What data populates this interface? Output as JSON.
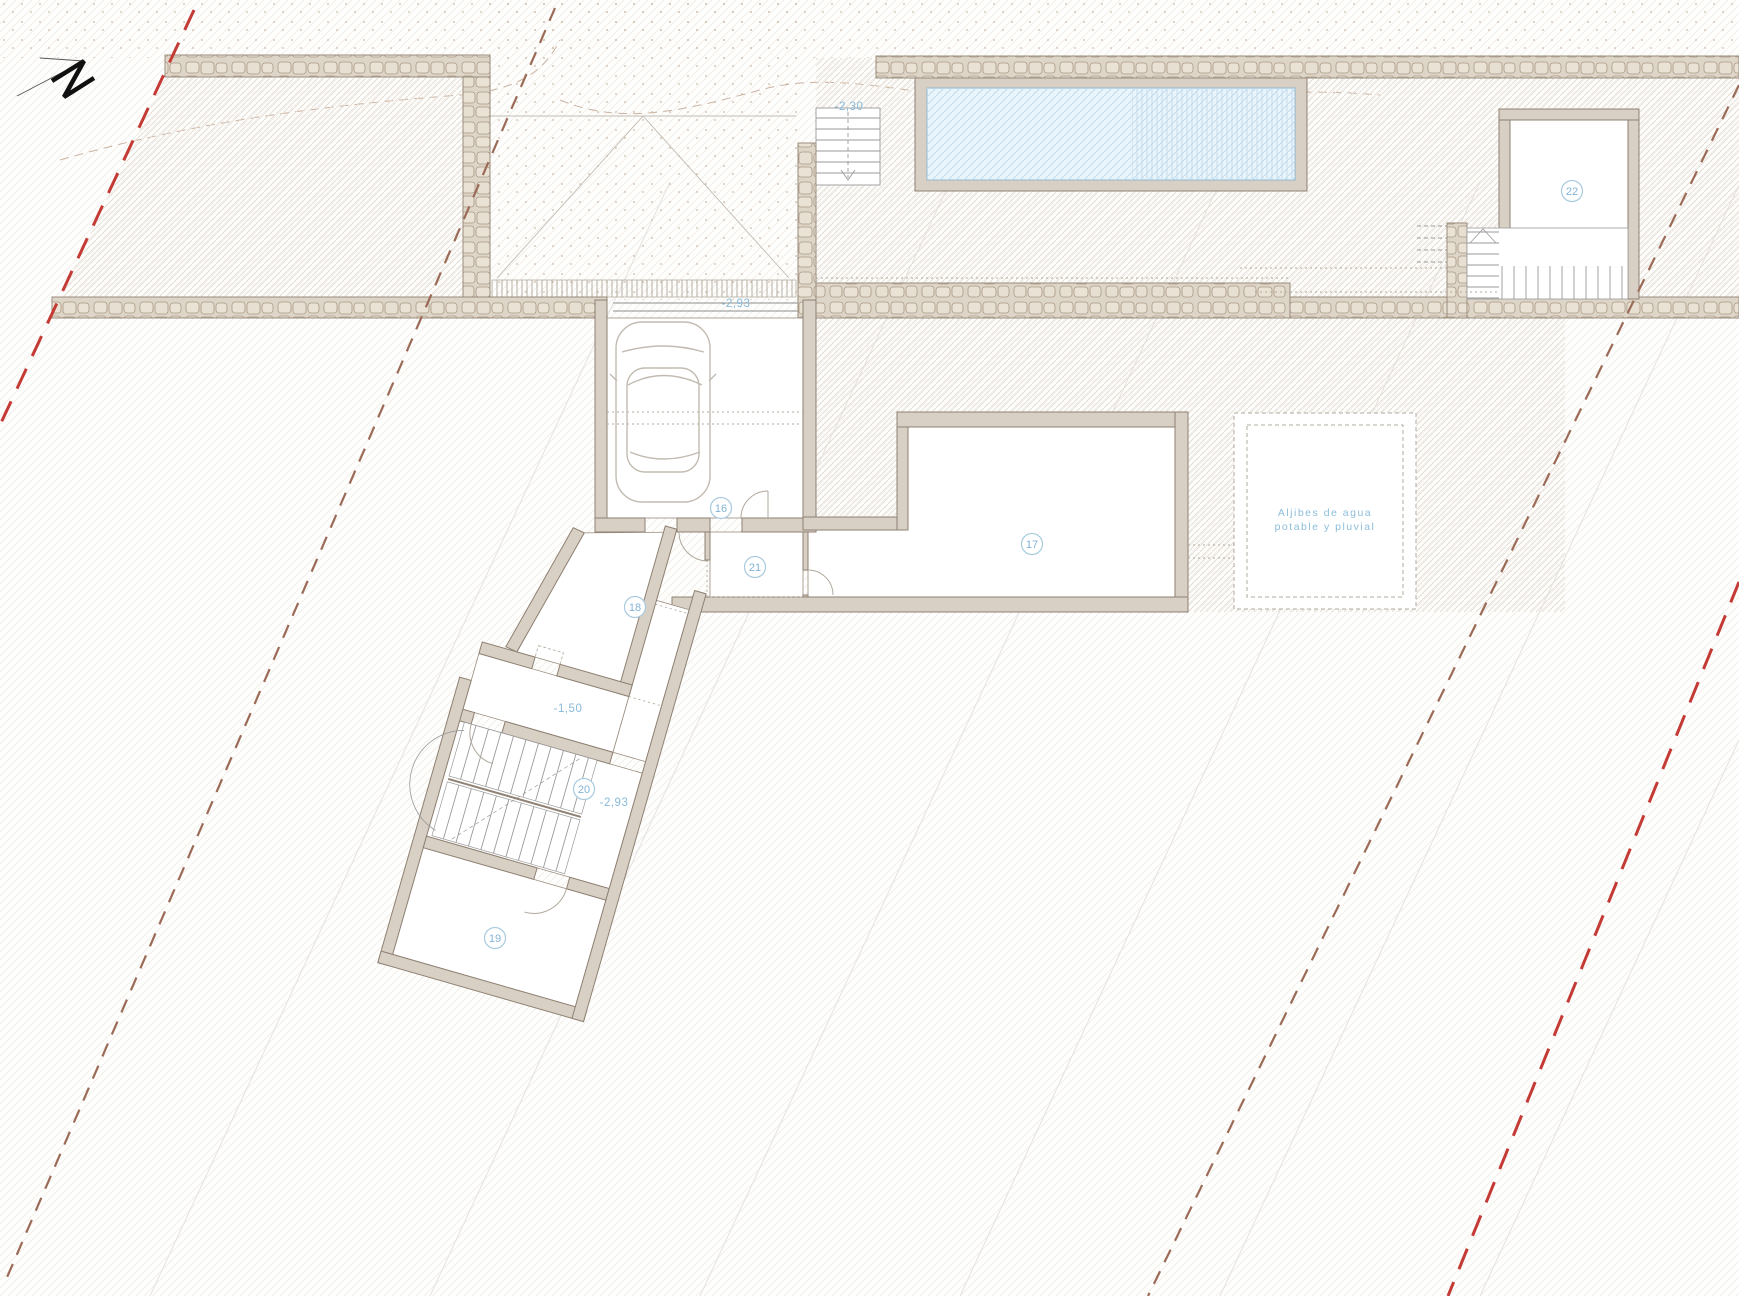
{
  "north": {
    "label": "N"
  },
  "rooms": [
    {
      "number": "16"
    },
    {
      "number": "17"
    },
    {
      "number": "18"
    },
    {
      "number": "19"
    },
    {
      "number": "20"
    },
    {
      "number": "21"
    },
    {
      "number": "22"
    }
  ],
  "levels": [
    {
      "value": "-2,30"
    },
    {
      "value": "-2,93"
    },
    {
      "value": "-1,50"
    },
    {
      "value": "-2,93"
    }
  ],
  "annotations": {
    "water_tanks_line1": "Aljibes  de  agua",
    "water_tanks_line2": "potable  y  pluvial"
  },
  "colors": {
    "label_blue": "#82b3d6",
    "boundary_red": "#c43a35",
    "boundary_brown": "#9b6b57",
    "wall_fill": "#d8d0c4",
    "wall_stroke": "#8f8173",
    "stone_fill": "#ddd5c8",
    "pool_water": "#eaf4fb",
    "pool_hatch": "#bedcee"
  }
}
